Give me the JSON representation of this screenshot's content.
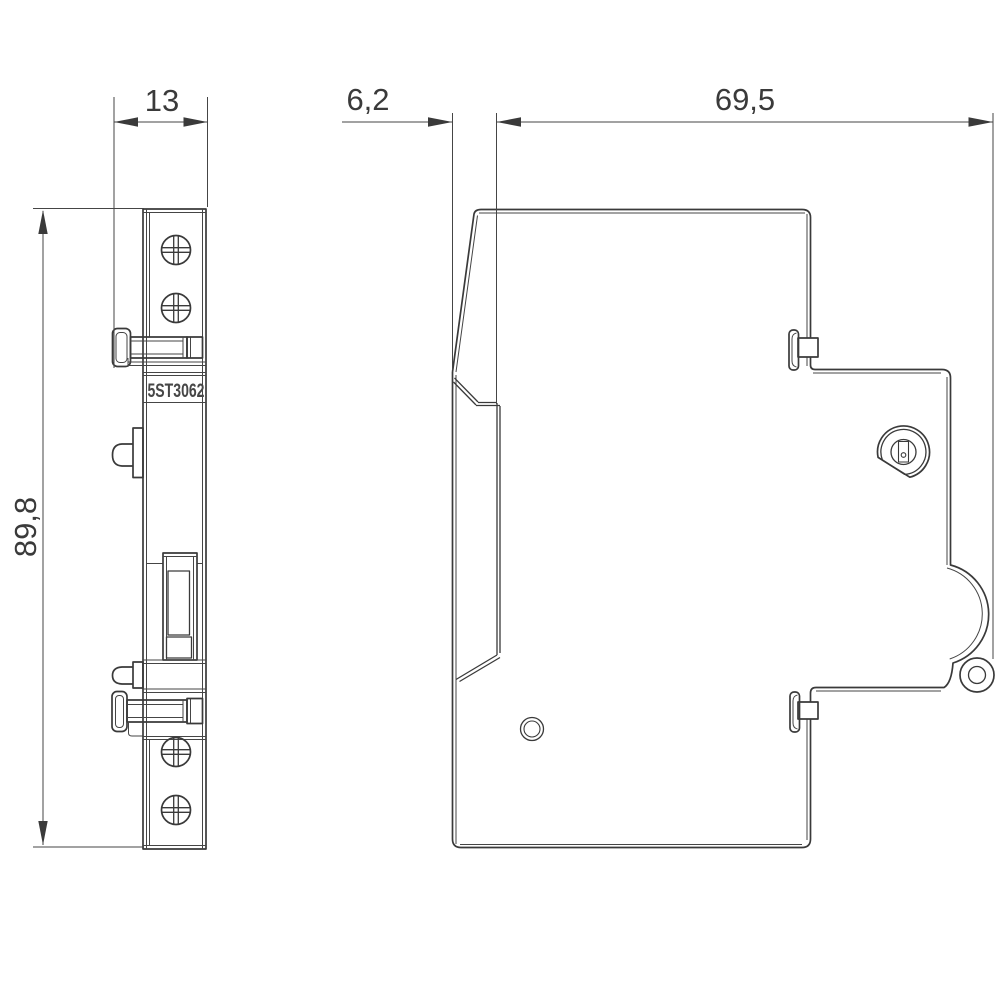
{
  "product": {
    "code": "5ST3062"
  },
  "dimensions": {
    "width_mm": "13",
    "height_mm": "89,8",
    "front_offset_mm": "6,2",
    "depth_mm": "69,5"
  }
}
